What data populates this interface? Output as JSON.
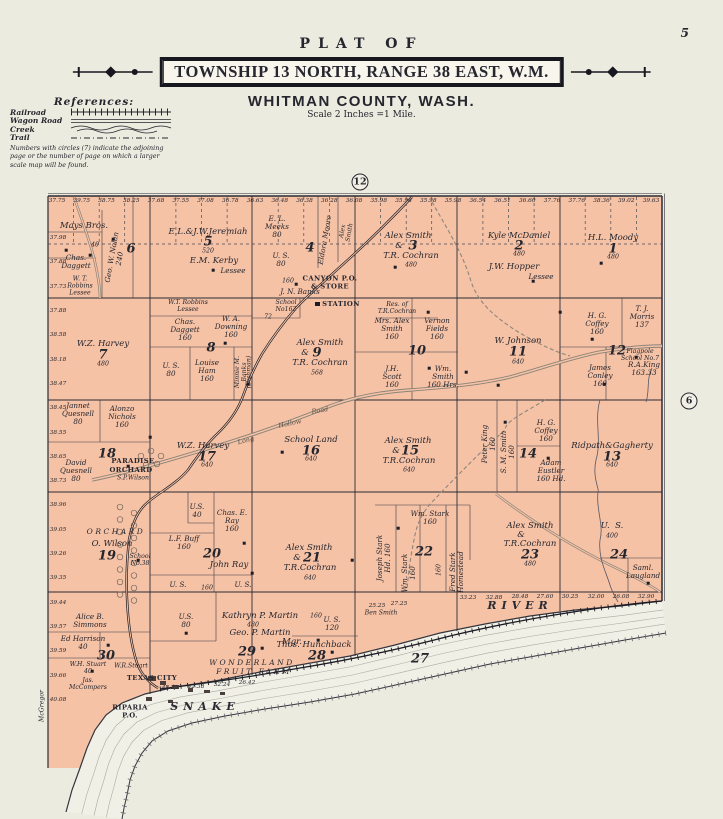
{
  "page": {
    "number": "5"
  },
  "header": {
    "plat_of": "PLAT OF",
    "township": "TOWNSHIP 13 NORTH, RANGE 38 EAST, W.M.",
    "county": "WHITMAN COUNTY, WASH.",
    "scale": "Scale 2 Inches =1 Mile."
  },
  "references": {
    "title": "References:",
    "items": [
      {
        "label": "Railroad"
      },
      {
        "label": "Wagon Road"
      },
      {
        "label": "Creek"
      },
      {
        "label": "Trail"
      }
    ],
    "note": "Numbers with circles (7) indicate the adjoining page or the number of page on which a larger scale map will be found."
  },
  "map": {
    "land_color": "#f5c2a6",
    "river_color": "#f1f0e6",
    "ink_color": "#2c2c35",
    "page_links": [
      {
        "value": "12",
        "x": 360,
        "y": 182
      },
      {
        "value": "6",
        "x": 689,
        "y": 401
      }
    ],
    "edge_numbers": {
      "top": {
        "y": 201,
        "x0": 57,
        "x1": 651,
        "values": [
          "37.75",
          "39.75",
          "38.75",
          "38.25",
          "37.68",
          "37.55",
          "37.08",
          "36.78",
          "36.63",
          "36.48",
          "36.38",
          "36.28",
          "36.08",
          "35.98",
          "35.98",
          "35.98",
          "35.98",
          "36.54",
          "36.51",
          "36.60",
          "37.76",
          "37.76",
          "38.36",
          "39.02",
          "39.63"
        ]
      },
      "left": {
        "x": 58,
        "y0": 238,
        "y1": 700,
        "values": [
          "37.98",
          "37.88",
          "37.73",
          "37.88",
          "38.58",
          "38.18",
          "38.47",
          "38.45",
          "38.55",
          "38.65",
          "38.73",
          "38.96",
          "39.05",
          "39.26",
          "39.35",
          "39.44",
          "39.57",
          "39.59",
          "39.66",
          "40.08"
        ]
      }
    },
    "labels": [
      {
        "t": "Mays Bros.",
        "x": 84,
        "y": 227,
        "c": "o"
      },
      {
        "t": "40",
        "x": 95,
        "y": 246,
        "c": "t"
      },
      {
        "t": "6",
        "x": 131,
        "y": 250,
        "c": "sn"
      },
      {
        "t": "Chas.\nDaggett",
        "x": 76,
        "y": 262,
        "c": "os"
      },
      {
        "t": "W. T.\nRobbins\nLessee",
        "x": 80,
        "y": 287,
        "c": "t"
      },
      {
        "t": "Geo. W. Nolan\n240",
        "x": 116,
        "y": 258,
        "c": "os",
        "r": -80
      },
      {
        "t": "E.L.&J.W.Jeremiah",
        "x": 208,
        "y": 233,
        "c": "o"
      },
      {
        "t": "5",
        "x": 208,
        "y": 243,
        "c": "sn"
      },
      {
        "t": "520",
        "x": 208,
        "y": 252,
        "c": "t"
      },
      {
        "t": "E.M. Kerby",
        "x": 214,
        "y": 262,
        "c": "o"
      },
      {
        "t": "Lessee",
        "x": 233,
        "y": 271,
        "c": "os"
      },
      {
        "t": "E. L.\nMeeks\n80",
        "x": 277,
        "y": 227,
        "c": "os"
      },
      {
        "t": "Eldora Moore",
        "x": 325,
        "y": 240,
        "c": "os",
        "r": -80
      },
      {
        "t": "Alex\nSmith",
        "x": 347,
        "y": 232,
        "c": "t",
        "r": -80
      },
      {
        "t": "4",
        "x": 310,
        "y": 249,
        "c": "sn"
      },
      {
        "t": "U. S.\n80",
        "x": 281,
        "y": 260,
        "c": "os"
      },
      {
        "t": "160",
        "x": 288,
        "y": 282,
        "c": "t"
      },
      {
        "t": "J. N. Banks",
        "x": 300,
        "y": 292,
        "c": "os"
      },
      {
        "t": "CANYON P.O.\n& STORE",
        "x": 330,
        "y": 283,
        "c": "b"
      },
      {
        "t": "School\nNo162",
        "x": 286,
        "y": 307,
        "c": "t"
      },
      {
        "t": "STATION",
        "x": 341,
        "y": 305,
        "c": "b"
      },
      {
        "t": "Alex Smith",
        "x": 408,
        "y": 237,
        "c": "o"
      },
      {
        "t": "&",
        "x": 399,
        "y": 247,
        "c": "o"
      },
      {
        "t": "3",
        "x": 413,
        "y": 247,
        "c": "sn"
      },
      {
        "t": "T.R. Cochran",
        "x": 411,
        "y": 257,
        "c": "o"
      },
      {
        "t": "480",
        "x": 411,
        "y": 266,
        "c": "t"
      },
      {
        "t": "Kyle McDaniel",
        "x": 519,
        "y": 237,
        "c": "o"
      },
      {
        "t": "2",
        "x": 519,
        "y": 247,
        "c": "sn"
      },
      {
        "t": "480",
        "x": 519,
        "y": 255,
        "c": "t"
      },
      {
        "t": "J.W. Hopper",
        "x": 514,
        "y": 268,
        "c": "o"
      },
      {
        "t": "Lessee",
        "x": 541,
        "y": 277,
        "c": "os"
      },
      {
        "t": "H.L. Moody",
        "x": 613,
        "y": 239,
        "c": "o"
      },
      {
        "t": "1",
        "x": 613,
        "y": 250,
        "c": "sn"
      },
      {
        "t": "480",
        "x": 613,
        "y": 258,
        "c": "t"
      },
      {
        "t": "W.Z. Harvey",
        "x": 103,
        "y": 345,
        "c": "o"
      },
      {
        "t": "7",
        "x": 103,
        "y": 356,
        "c": "sn"
      },
      {
        "t": "480",
        "x": 103,
        "y": 365,
        "c": "t"
      },
      {
        "t": "W.T. Robbins\nLessee",
        "x": 188,
        "y": 307,
        "c": "t"
      },
      {
        "t": "Chas.\nDaggett\n160",
        "x": 185,
        "y": 330,
        "c": "os"
      },
      {
        "t": "W. A.\nDowning\n160",
        "x": 231,
        "y": 327,
        "c": "os"
      },
      {
        "t": "8",
        "x": 211,
        "y": 349,
        "c": "sn"
      },
      {
        "t": "72",
        "x": 268,
        "y": 318,
        "c": "t"
      },
      {
        "t": "U. S.\n80",
        "x": 171,
        "y": 370,
        "c": "os"
      },
      {
        "t": "Louise\nHam\n160",
        "x": 207,
        "y": 371,
        "c": "os"
      },
      {
        "t": "Minnie M.\nBanks",
        "x": 242,
        "y": 372,
        "c": "t",
        "r": -90
      },
      {
        "t": "(Dishman)",
        "x": 250,
        "y": 372,
        "c": "t",
        "r": -90
      },
      {
        "t": "Alex Smith",
        "x": 320,
        "y": 344,
        "c": "o"
      },
      {
        "t": "&",
        "x": 305,
        "y": 354,
        "c": "o"
      },
      {
        "t": "9",
        "x": 317,
        "y": 354,
        "c": "sn"
      },
      {
        "t": "T.R. Cochran",
        "x": 320,
        "y": 364,
        "c": "o"
      },
      {
        "t": "568",
        "x": 317,
        "y": 374,
        "c": "t"
      },
      {
        "t": "Res. of\nT.R.Cochran",
        "x": 397,
        "y": 309,
        "c": "t"
      },
      {
        "t": "Mrs. Alex\nSmith\n160",
        "x": 392,
        "y": 329,
        "c": "os"
      },
      {
        "t": "Vernon\nFields\n160",
        "x": 437,
        "y": 329,
        "c": "os"
      },
      {
        "t": "10",
        "x": 417,
        "y": 352,
        "c": "sn"
      },
      {
        "t": "J.H.\nScott\n160",
        "x": 392,
        "y": 377,
        "c": "os"
      },
      {
        "t": "Wm.\nSmith\n160 Hrs.",
        "x": 443,
        "y": 377,
        "c": "os"
      },
      {
        "t": "W. Johnson",
        "x": 518,
        "y": 342,
        "c": "o"
      },
      {
        "t": "11",
        "x": 518,
        "y": 353,
        "c": "sn"
      },
      {
        "t": "640",
        "x": 518,
        "y": 363,
        "c": "t"
      },
      {
        "t": "H. G.\nCoffey\n160",
        "x": 597,
        "y": 324,
        "c": "os"
      },
      {
        "t": "T. J.\nMorris\n137",
        "x": 642,
        "y": 317,
        "c": "os"
      },
      {
        "t": "12",
        "x": 617,
        "y": 352,
        "c": "sn"
      },
      {
        "t": "Flagpole\nSchool No.7",
        "x": 640,
        "y": 356,
        "c": "t"
      },
      {
        "t": "James\nConley\n160",
        "x": 600,
        "y": 376,
        "c": "os"
      },
      {
        "t": "R.A.King\n163.33",
        "x": 644,
        "y": 369,
        "c": "os"
      },
      {
        "t": "Jannet\nQuesnell\n80",
        "x": 78,
        "y": 414,
        "c": "os"
      },
      {
        "t": "Alonzo\nNichols\n160",
        "x": 122,
        "y": 417,
        "c": "os"
      },
      {
        "t": "18",
        "x": 107,
        "y": 455,
        "c": "sn"
      },
      {
        "t": "PARADISE",
        "x": 133,
        "y": 462,
        "c": "b"
      },
      {
        "t": "ORCHARD",
        "x": 131,
        "y": 471,
        "c": "b"
      },
      {
        "t": "S.P.Wilson",
        "x": 133,
        "y": 479,
        "c": "t"
      },
      {
        "t": "David\nQuesnell\n80",
        "x": 76,
        "y": 471,
        "c": "os"
      },
      {
        "t": "W.Z. Harvey",
        "x": 203,
        "y": 447,
        "c": "o"
      },
      {
        "t": "17",
        "x": 207,
        "y": 458,
        "c": "sn"
      },
      {
        "t": "640",
        "x": 207,
        "y": 466,
        "c": "t"
      },
      {
        "t": "Long",
        "x": 246,
        "y": 441,
        "c": "rd",
        "r": -14
      },
      {
        "t": "Hollow",
        "x": 290,
        "y": 424,
        "c": "rd",
        "r": -12
      },
      {
        "t": "Road",
        "x": 320,
        "y": 411,
        "c": "rd",
        "r": -10
      },
      {
        "t": "School Land",
        "x": 311,
        "y": 441,
        "c": "o"
      },
      {
        "t": "16",
        "x": 311,
        "y": 452,
        "c": "sn"
      },
      {
        "t": "640",
        "x": 311,
        "y": 460,
        "c": "t"
      },
      {
        "t": "Alex Smith",
        "x": 408,
        "y": 442,
        "c": "o"
      },
      {
        "t": "&",
        "x": 396,
        "y": 452,
        "c": "o"
      },
      {
        "t": "15",
        "x": 410,
        "y": 452,
        "c": "sn"
      },
      {
        "t": "T.R.Cochran",
        "x": 409,
        "y": 462,
        "c": "o"
      },
      {
        "t": "640",
        "x": 409,
        "y": 471,
        "c": "t"
      },
      {
        "t": "Peter King\n160",
        "x": 489,
        "y": 444,
        "c": "os",
        "r": -90
      },
      {
        "t": "S. M. Smith\n160",
        "x": 508,
        "y": 452,
        "c": "os",
        "r": -90
      },
      {
        "t": "H. G.\nCoffey\n160",
        "x": 546,
        "y": 431,
        "c": "os"
      },
      {
        "t": "14",
        "x": 528,
        "y": 455,
        "c": "sn"
      },
      {
        "t": "Adam\nEustler\n160 Hd.",
        "x": 551,
        "y": 471,
        "c": "os"
      },
      {
        "t": "Ridpath&Gagherty",
        "x": 612,
        "y": 447,
        "c": "o"
      },
      {
        "t": "13",
        "x": 612,
        "y": 458,
        "c": "sn"
      },
      {
        "t": "640",
        "x": 612,
        "y": 466,
        "c": "t"
      },
      {
        "t": "ORCHARD",
        "x": 116,
        "y": 532,
        "c": "sp"
      },
      {
        "t": "O. Wilson",
        "x": 112,
        "y": 545,
        "c": "o"
      },
      {
        "t": "19",
        "x": 107,
        "y": 557,
        "c": "sn"
      },
      {
        "t": "School\nNo.38",
        "x": 140,
        "y": 561,
        "c": "t"
      },
      {
        "t": "U.S.\n40",
        "x": 197,
        "y": 511,
        "c": "os"
      },
      {
        "t": "Chas. E.\nRay\n160",
        "x": 232,
        "y": 521,
        "c": "os"
      },
      {
        "t": "L.F. Buff\n160",
        "x": 184,
        "y": 543,
        "c": "os"
      },
      {
        "t": "20",
        "x": 212,
        "y": 555,
        "c": "sn"
      },
      {
        "t": "John Ray",
        "x": 229,
        "y": 566,
        "c": "o"
      },
      {
        "t": "U. S.",
        "x": 178,
        "y": 585,
        "c": "os"
      },
      {
        "t": "160",
        "x": 207,
        "y": 589,
        "c": "t"
      },
      {
        "t": "U. S.",
        "x": 243,
        "y": 585,
        "c": "os"
      },
      {
        "t": "Alex Smith",
        "x": 309,
        "y": 549,
        "c": "o"
      },
      {
        "t": "&",
        "x": 297,
        "y": 559,
        "c": "o"
      },
      {
        "t": "21",
        "x": 312,
        "y": 559,
        "c": "sn"
      },
      {
        "t": "T.R.Cochran",
        "x": 310,
        "y": 569,
        "c": "o"
      },
      {
        "t": "640",
        "x": 310,
        "y": 579,
        "c": "t"
      },
      {
        "t": "Wm. Stark\n160",
        "x": 430,
        "y": 518,
        "c": "os"
      },
      {
        "t": "Joseph Stark\nHd. 160",
        "x": 384,
        "y": 558,
        "c": "os",
        "r": -90
      },
      {
        "t": "Wm. Stark\n160",
        "x": 409,
        "y": 573,
        "c": "os",
        "r": -90
      },
      {
        "t": "22",
        "x": 424,
        "y": 553,
        "c": "sn"
      },
      {
        "t": "160",
        "x": 440,
        "y": 570,
        "c": "t",
        "r": -90
      },
      {
        "t": "Fred Stark\nHomestead",
        "x": 457,
        "y": 572,
        "c": "os",
        "r": -90
      },
      {
        "t": "Alex Smith",
        "x": 530,
        "y": 527,
        "c": "o"
      },
      {
        "t": "&",
        "x": 521,
        "y": 536,
        "c": "o"
      },
      {
        "t": "T.R.Cochran",
        "x": 530,
        "y": 545,
        "c": "o"
      },
      {
        "t": "23",
        "x": 530,
        "y": 556,
        "c": "sn"
      },
      {
        "t": "480",
        "x": 530,
        "y": 565,
        "c": "t"
      },
      {
        "t": "U.  S.",
        "x": 612,
        "y": 527,
        "c": "o"
      },
      {
        "t": "400",
        "x": 612,
        "y": 537,
        "c": "t"
      },
      {
        "t": "24",
        "x": 619,
        "y": 556,
        "c": "sn"
      },
      {
        "t": "Saml.\nLaugland",
        "x": 643,
        "y": 572,
        "c": "os"
      },
      {
        "t": "Alice B.\nSimmons",
        "x": 90,
        "y": 621,
        "c": "os"
      },
      {
        "t": "Ed Harrison\n40",
        "x": 83,
        "y": 643,
        "c": "os"
      },
      {
        "t": "30",
        "x": 106,
        "y": 657,
        "c": "sn"
      },
      {
        "t": "W.H. Stuart\n40",
        "x": 88,
        "y": 669,
        "c": "t"
      },
      {
        "t": "W.R.Stuart",
        "x": 131,
        "y": 667,
        "c": "t"
      },
      {
        "t": "TEXAS CITY",
        "x": 152,
        "y": 679,
        "c": "b"
      },
      {
        "t": "Jas.\nMcCompers",
        "x": 88,
        "y": 685,
        "c": "t"
      },
      {
        "t": "RIPARIA\nP.O.",
        "x": 130,
        "y": 712,
        "c": "b"
      },
      {
        "t": "U.S.\n80",
        "x": 186,
        "y": 621,
        "c": "os"
      },
      {
        "t": "Kathryn P. Martin",
        "x": 260,
        "y": 617,
        "c": "o"
      },
      {
        "t": "480",
        "x": 253,
        "y": 626,
        "c": "t"
      },
      {
        "t": "Geo. P. Martin",
        "x": 260,
        "y": 634,
        "c": "o"
      },
      {
        "t": "Mgr.",
        "x": 292,
        "y": 643,
        "c": "o"
      },
      {
        "t": "29",
        "x": 247,
        "y": 653,
        "c": "sn"
      },
      {
        "t": "WONDERLAND",
        "x": 252,
        "y": 663,
        "c": "sp"
      },
      {
        "t": "FRUIT FARM",
        "x": 254,
        "y": 672,
        "c": "sp"
      },
      {
        "t": "160",
        "x": 316,
        "y": 617,
        "c": "t"
      },
      {
        "t": "U. S.\n120",
        "x": 332,
        "y": 624,
        "c": "os"
      },
      {
        "t": "Thos. Hunchback",
        "x": 314,
        "y": 646,
        "c": "o"
      },
      {
        "t": "28",
        "x": 317,
        "y": 657,
        "c": "sn"
      },
      {
        "t": "Ben Smith",
        "x": 381,
        "y": 614,
        "c": "t"
      },
      {
        "t": "27",
        "x": 420,
        "y": 660,
        "c": "sn"
      },
      {
        "t": "SNAKE",
        "x": 205,
        "y": 707,
        "c": "rl"
      },
      {
        "t": "RIVER",
        "x": 520,
        "y": 606,
        "c": "rl"
      },
      {
        "t": "McGregor",
        "x": 43,
        "y": 706,
        "c": "t",
        "r": -90
      },
      {
        "t": "25.25",
        "x": 377,
        "y": 606,
        "c": "en"
      },
      {
        "t": "27.25",
        "x": 399,
        "y": 604,
        "c": "en"
      },
      {
        "t": "42.25",
        "x": 170,
        "y": 688,
        "c": "en"
      },
      {
        "t": "42.38",
        "x": 196,
        "y": 687,
        "c": "en"
      },
      {
        "t": "32.24",
        "x": 222,
        "y": 685,
        "c": "en"
      },
      {
        "t": "26.42",
        "x": 247,
        "y": 683,
        "c": "en"
      },
      {
        "t": "33.23",
        "x": 468,
        "y": 598,
        "c": "en"
      },
      {
        "t": "32.88",
        "x": 494,
        "y": 598,
        "c": "en"
      },
      {
        "t": "28.48",
        "x": 520,
        "y": 597,
        "c": "en"
      },
      {
        "t": "27.60",
        "x": 545,
        "y": 597,
        "c": "en"
      },
      {
        "t": "30.25",
        "x": 570,
        "y": 597,
        "c": "en"
      },
      {
        "t": "32.00",
        "x": 596,
        "y": 597,
        "c": "en"
      },
      {
        "t": "26.08",
        "x": 621,
        "y": 597,
        "c": "en"
      },
      {
        "t": "32.90",
        "x": 646,
        "y": 597,
        "c": "en"
      }
    ],
    "house_markers": [
      [
        113,
        239
      ],
      [
        90,
        255
      ],
      [
        66,
        250
      ],
      [
        213,
        270
      ],
      [
        296,
        284
      ],
      [
        395,
        267
      ],
      [
        533,
        281
      ],
      [
        601,
        263
      ],
      [
        225,
        343
      ],
      [
        248,
        384
      ],
      [
        428,
        312
      ],
      [
        560,
        312
      ],
      [
        498,
        385
      ],
      [
        592,
        339
      ],
      [
        636,
        357
      ],
      [
        604,
        384
      ],
      [
        548,
        458
      ],
      [
        505,
        422
      ],
      [
        150,
        437
      ],
      [
        128,
        466
      ],
      [
        282,
        452
      ],
      [
        138,
        560
      ],
      [
        244,
        543
      ],
      [
        252,
        573
      ],
      [
        352,
        560
      ],
      [
        398,
        528
      ],
      [
        648,
        583
      ],
      [
        262,
        648
      ],
      [
        318,
        640
      ],
      [
        108,
        645
      ],
      [
        92,
        671
      ],
      [
        332,
        652
      ],
      [
        186,
        633
      ],
      [
        429,
        368
      ],
      [
        466,
        372
      ]
    ]
  }
}
